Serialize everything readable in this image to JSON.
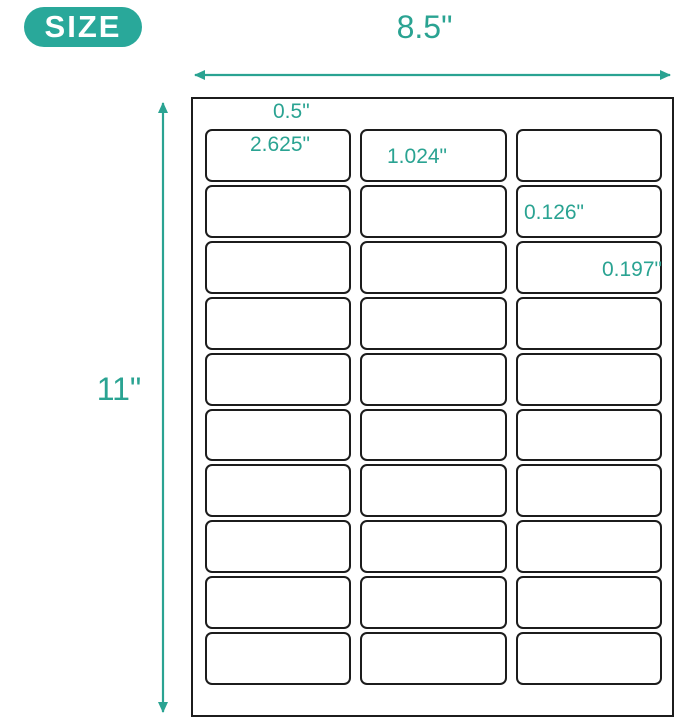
{
  "badge": {
    "label": "SIZE"
  },
  "colors": {
    "accent_teal": "#2AA392",
    "badge_teal": "#29A89A",
    "line_black": "#1c1c1c",
    "background": "#ffffff"
  },
  "sheet": {
    "grid": {
      "rows": 10,
      "columns": 3
    }
  },
  "dimensions": {
    "sheet_width": "8.5\"",
    "sheet_height": "11\"",
    "top_margin": "0.5\"",
    "label_width": "2.625\"",
    "label_height": "1.024\"",
    "column_gap": "0.126\"",
    "side_margin": "0.197\""
  }
}
